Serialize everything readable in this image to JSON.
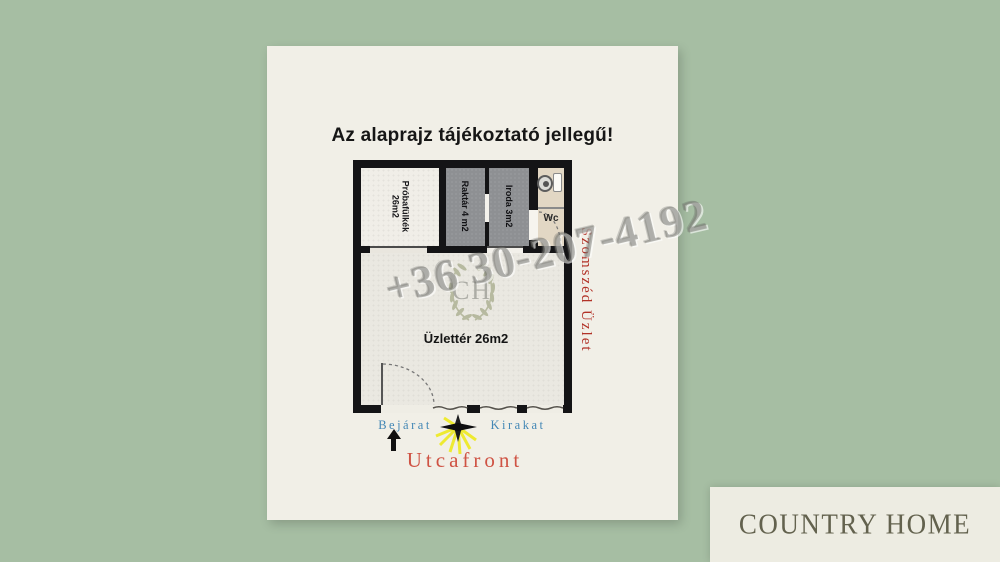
{
  "title": "Az alaprajz tájékoztató jellegű!",
  "floorplan": {
    "rooms": [
      {
        "id": "fitting",
        "label": "Próbafülkék",
        "area": "26m2"
      },
      {
        "id": "storage",
        "label": "Raktár 4 m2"
      },
      {
        "id": "office",
        "label": "Iroda 3m2"
      },
      {
        "id": "wc",
        "label": "Wc"
      },
      {
        "id": "shop",
        "label": "Üzlettér 26m2"
      }
    ],
    "neighbor_label": "Szomszéd Üzlet",
    "entrance_label": "Bejárat",
    "shopwindow_label": "Kirakat",
    "street_label": "Utcafront"
  },
  "watermark": {
    "phone": "+36 30-207-4192",
    "monogram": "CH"
  },
  "logo": {
    "brand": "COUNTRY HOME"
  },
  "colors": {
    "page_bg": "#a6bea3",
    "panel_bg": "#f1efe7",
    "wall": "#141416",
    "room_gray": "#8e9093",
    "room_wc_beige": "#e2d7c4",
    "shop_floor": "#eae8e1",
    "street_red": "#cf5344",
    "neighbor_red": "#b23227",
    "label_blue": "#4387b5",
    "wreath_olive": "#9ba17c",
    "ray_yellow": "#eeea28",
    "logo_text": "#63624e"
  }
}
